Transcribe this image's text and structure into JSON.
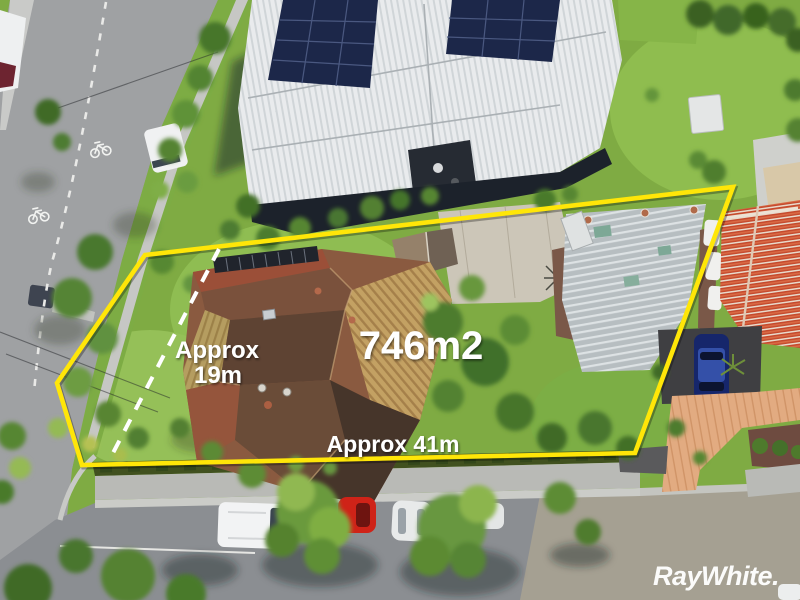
{
  "overlay": {
    "area_label": "746m2",
    "side_label_line1": "Approx",
    "side_label_line2": "19m",
    "frontage_label": "Approx 41m",
    "boundary_color": "#ffe608",
    "dimension_line_color": "#ffffff",
    "label_color": "#ffffff"
  },
  "branding": {
    "logo_text": "RayWhite.",
    "logo_color": "#ffffff"
  }
}
